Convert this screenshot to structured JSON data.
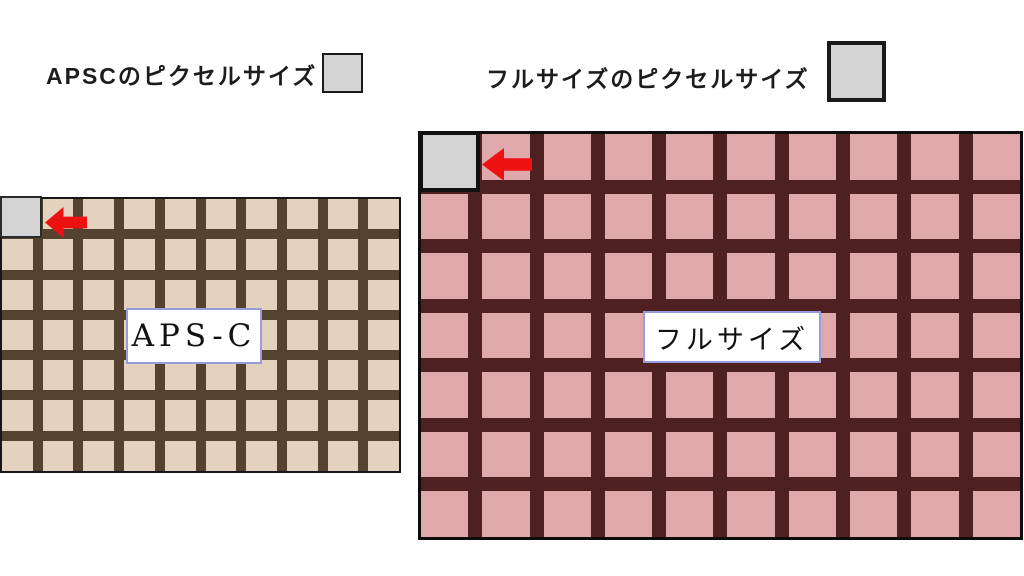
{
  "page": {
    "background": "#ffffff"
  },
  "header": {
    "apsc_title": "APSCのピクセルサイズ",
    "full_title": "フルサイズのピクセルサイズ"
  },
  "swatches": {
    "fill": "#d4d4d4",
    "border": "#1a1a1a"
  },
  "grids": {
    "apsc": {
      "label": "APS-C",
      "rows": 7,
      "cols": 10,
      "cell_color": "#e3d3be",
      "line_color": "#55432f",
      "border_color": "#161616",
      "highlight_color": "#d4d4d4"
    },
    "full": {
      "label": "フルサイズ",
      "rows": 7,
      "cols": 10,
      "cell_color": "#dfa9ac",
      "line_color": "#4f2022",
      "border_color": "#0d0d0d",
      "highlight_color": "#d4d4d4"
    }
  },
  "colors": {
    "arrow_red": "#ee1111",
    "label_box_border": "#9a9ade",
    "label_box_bg": "#ffffff"
  }
}
